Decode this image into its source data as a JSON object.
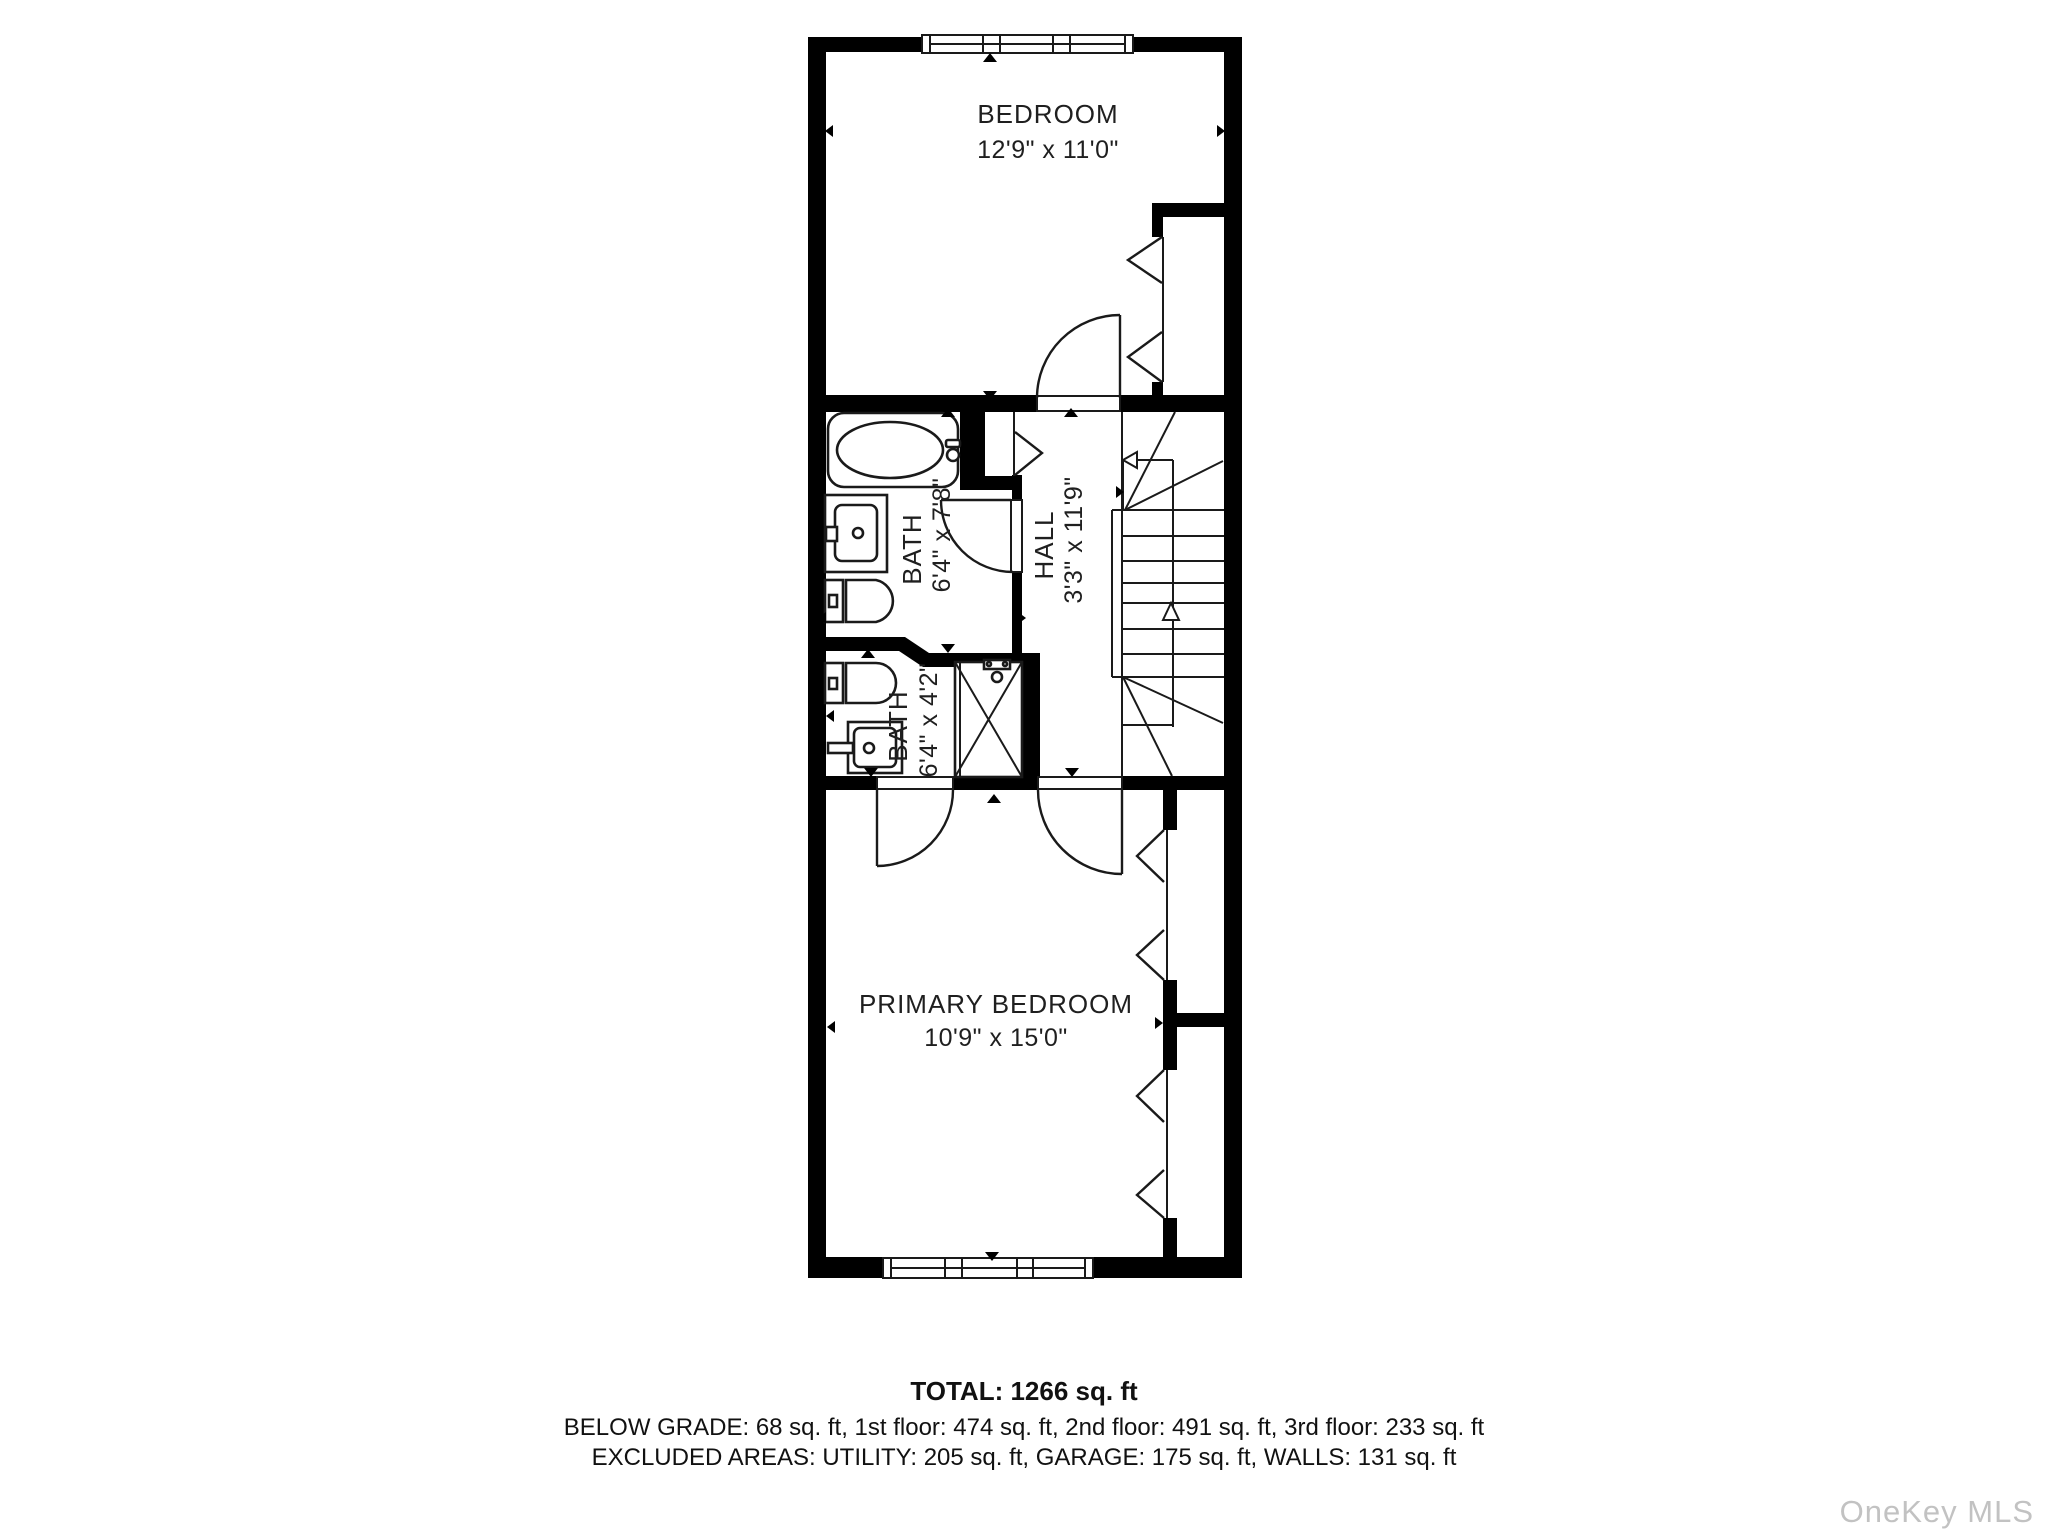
{
  "floorplan": {
    "rooms": [
      {
        "name": "BEDROOM",
        "dims": "12'9\" x 11'0\""
      },
      {
        "name": "BATH",
        "dims": "6'4\" x 7'8\""
      },
      {
        "name": "HALL",
        "dims": "3'3\" x 11'9\""
      },
      {
        "name": "BATH",
        "dims": "6'4\" x 4'2\""
      },
      {
        "name": "PRIMARY BEDROOM",
        "dims": "10'9\" x 15'0\""
      }
    ]
  },
  "summary": {
    "total": "TOTAL: 1266 sq. ft",
    "floors": "BELOW GRADE: 68 sq. ft, 1st floor: 474 sq. ft, 2nd floor: 491 sq. ft, 3rd floor: 233 sq. ft",
    "excluded": "EXCLUDED AREAS: UTILITY: 205 sq. ft, GARAGE: 175 sq. ft, WALLS: 131 sq. ft"
  },
  "watermark": "OneKey MLS",
  "colors": {
    "walls": "#000000",
    "background": "#ffffff",
    "text": "#1f1f1f",
    "watermark": "#c2c2c2"
  }
}
